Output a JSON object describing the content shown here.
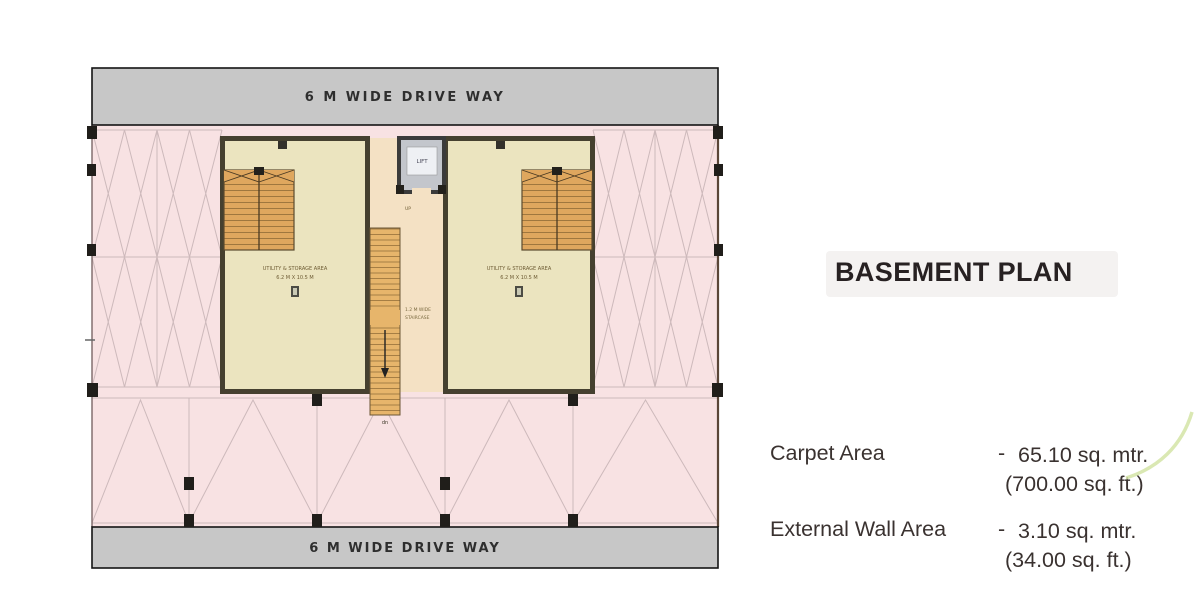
{
  "plan": {
    "driveways": {
      "top": "6 M WIDE DRIVE WAY",
      "bottom": "6 M WIDE DRIVE WAY"
    },
    "units": [
      {
        "name": "UTILITY & STORAGE AREA",
        "size": "6.2 M X 10.5 M"
      },
      {
        "name": "UTILITY & STORAGE AREA",
        "size": "6.2 M X 10.5 M"
      }
    ],
    "lift_label": "LIFT",
    "stair": {
      "up": "UP",
      "down": "dn",
      "width_label_line1": "1.2 M WIDE",
      "width_label_line2": "STAIRCASE"
    },
    "colors": {
      "parking": "#f8e2e3",
      "driveway": "#c7c7c7",
      "room": "#ebe4bf",
      "lobby": "#f4e1c4",
      "stairs": "#e0a75f",
      "walls": "#45402f",
      "accent_swoosh": "#d4e4a6"
    }
  },
  "panel": {
    "title": "BASEMENT PLAN",
    "stats": [
      {
        "label": "Carpet Area",
        "sep": "-",
        "metric": "65.10 sq. mtr.",
        "imperial": "(700.00 sq. ft.)"
      },
      {
        "label": "External Wall Area",
        "sep": "-",
        "metric": "3.10 sq. mtr.",
        "imperial": "(34.00 sq. ft.)"
      }
    ]
  }
}
